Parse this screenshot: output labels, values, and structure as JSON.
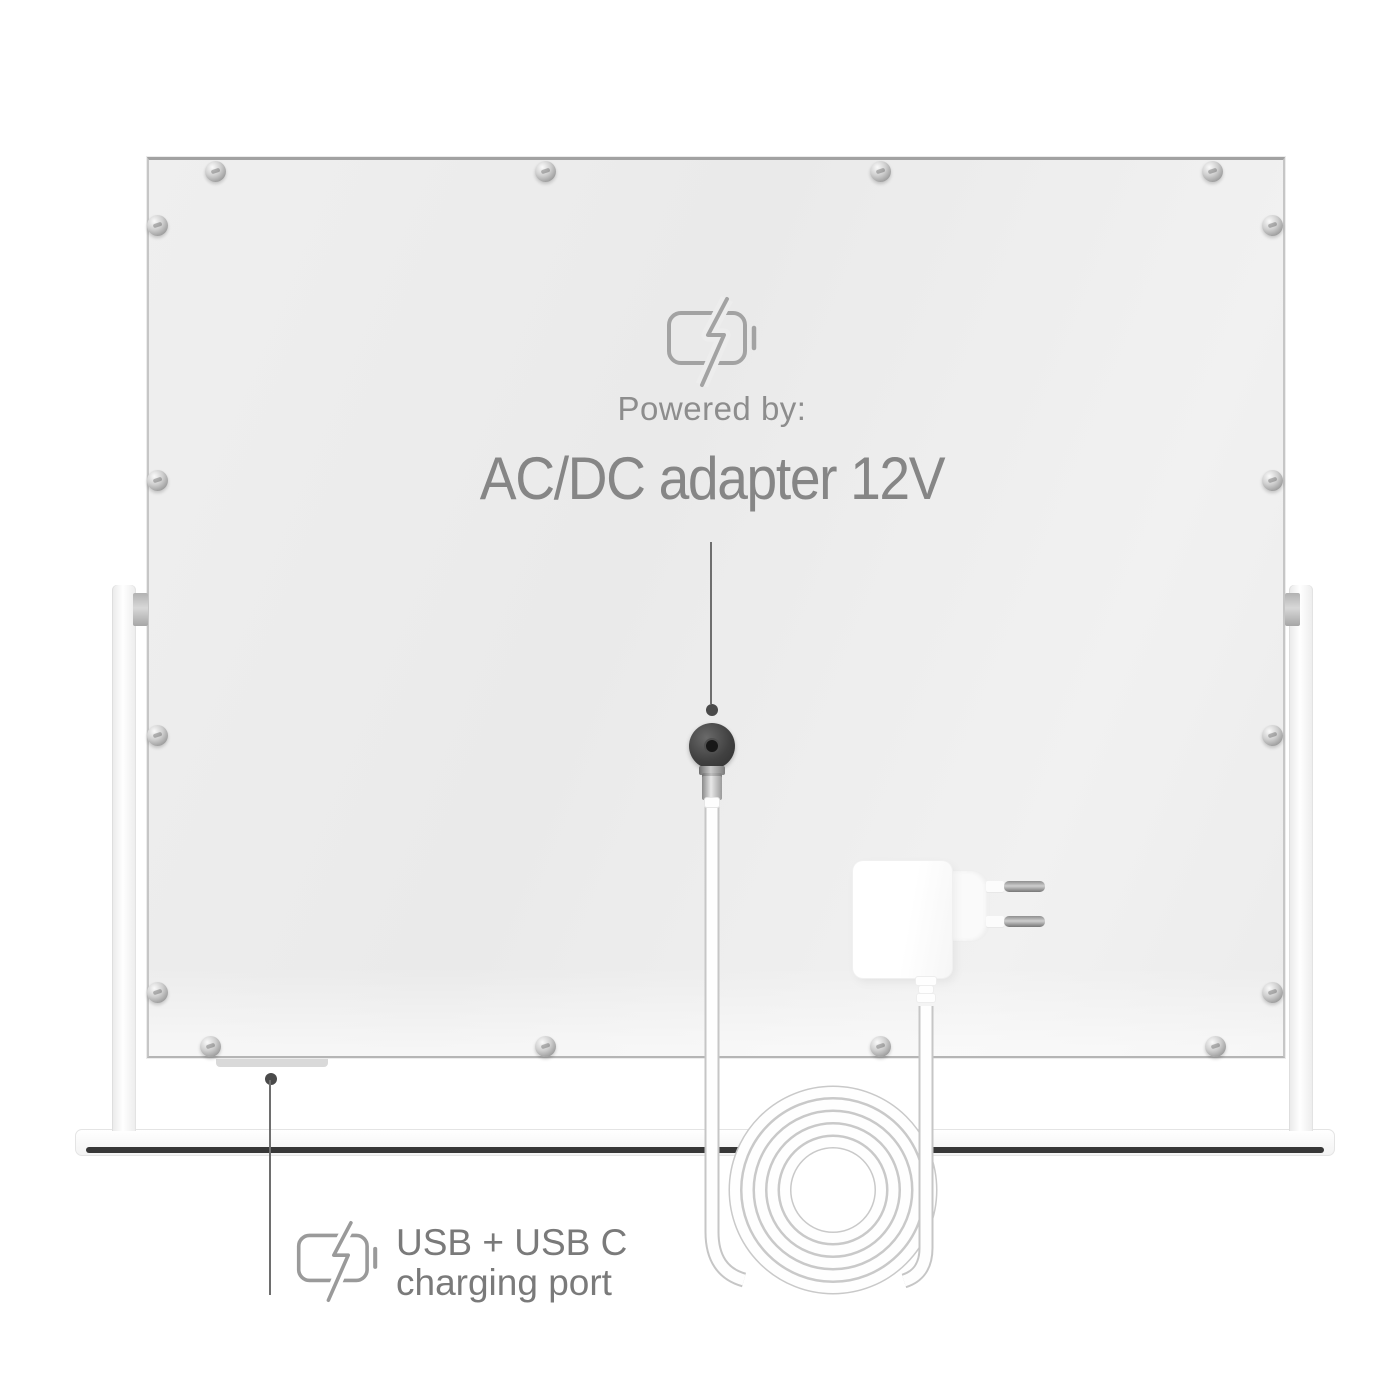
{
  "power_annotation": {
    "icon": "battery-charging-icon",
    "lead_in": "Powered by:",
    "label": "AC/DC adapter 12V",
    "text_color": "#8a8a8a"
  },
  "usb_annotation": {
    "icon": "battery-charging-icon",
    "line1": "USB + USB C",
    "line2": "charging port",
    "text_color": "#7a7a7a"
  },
  "colors": {
    "background": "#ffffff",
    "panel_fill": "#ededed",
    "leader_line": "#6e6e6e",
    "icon_stroke": "#a3a3a3",
    "base_strip": "#373737",
    "dc_port": "#3c3c3c",
    "metal": "#bdbdbd"
  }
}
